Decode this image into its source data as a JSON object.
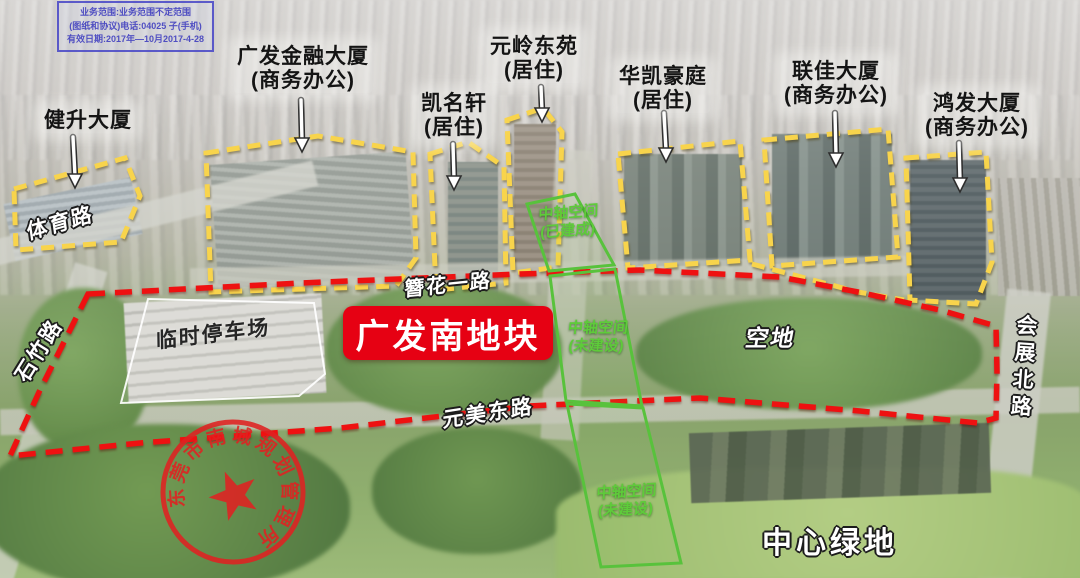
{
  "watermark": {
    "line1": "业务范围:业务范围不定范围",
    "line2": "(图纸和协议)电话:04025 子(手机)",
    "line3": "有效日期:2017年—10月2017-4-28"
  },
  "site_badge": {
    "label": "广发南地块"
  },
  "buildings": [
    {
      "name": "健升大厦",
      "subtitle": ""
    },
    {
      "name": "广发金融大厦",
      "subtitle": "(商务办公)"
    },
    {
      "name": "凯名轩",
      "subtitle": "(居住)"
    },
    {
      "name": "元岭东苑",
      "subtitle": "(居住)"
    },
    {
      "name": "华凯豪庭",
      "subtitle": "(居住)"
    },
    {
      "name": "联佳大厦",
      "subtitle": "(商务办公)"
    },
    {
      "name": "鸿发大厦",
      "subtitle": "(商务办公)"
    }
  ],
  "roads": {
    "tiyu": "体育路",
    "shizhu": "石竹路",
    "zanhua": "簪花一路",
    "yuanmei": "元美东路",
    "huizhan": "会展北路"
  },
  "zones": {
    "parking": "临时停车场",
    "axis_built_line1": "中轴空间",
    "axis_built_line2": "(已建成)",
    "axis_unbuilt_line1": "中轴空间",
    "axis_unbuilt_line2": "(未建设)",
    "vacant": "空地",
    "central_green": "中心绿地"
  },
  "stamp": {
    "text": "东莞市南城规划管理所"
  },
  "colors": {
    "boundary_red": "#ee1111",
    "badge_red": "#e60113",
    "outline_yellow": "#f8d44c",
    "axis_green": "#58c23c",
    "stamp_red": "#e02222"
  }
}
